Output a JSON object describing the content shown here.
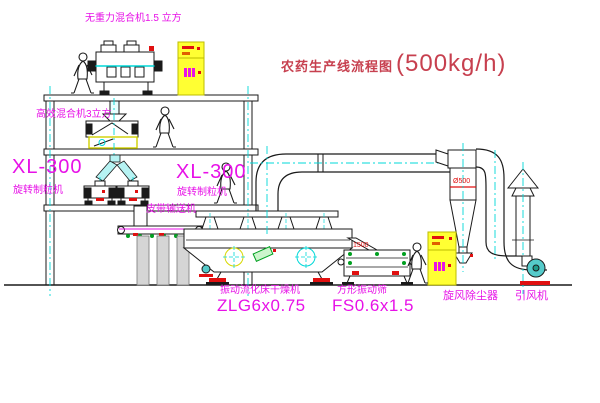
{
  "title": {
    "text": "农药生产线流程图",
    "capacity": "(500kg/h)"
  },
  "equipment_labels": {
    "gravity_mixer": "无重力混合机1.5 立方",
    "high_eff_mixer": "高效混合机3立方",
    "granulator_left": {
      "model": "XL-300",
      "name": "旋转制粒机"
    },
    "granulator_right": {
      "model": "XL-300",
      "name": "旋转制粒机"
    },
    "belt_conveyor": "皮带输送机",
    "fluid_bed_dryer": {
      "name": "振动流化床干燥机",
      "model": "ZLG6x0.75"
    },
    "square_sieve": {
      "name": "方形振动筛",
      "model": "FS0.6x1.5"
    },
    "cyclone": "旋风除尘器",
    "induced_draft_fan": "引风机"
  },
  "annotations": {
    "cyclone_diameter": "Ø500",
    "dimension": "1500"
  },
  "colors": {
    "label_magenta": "#e711e7",
    "title_red": "#c7404f",
    "line_black": "#1a1a1a",
    "centerline_cyan": "#00d8d8",
    "cabinet_yellow": "#ffff33",
    "detail_red": "#e01010",
    "detail_green": "#00a020"
  }
}
